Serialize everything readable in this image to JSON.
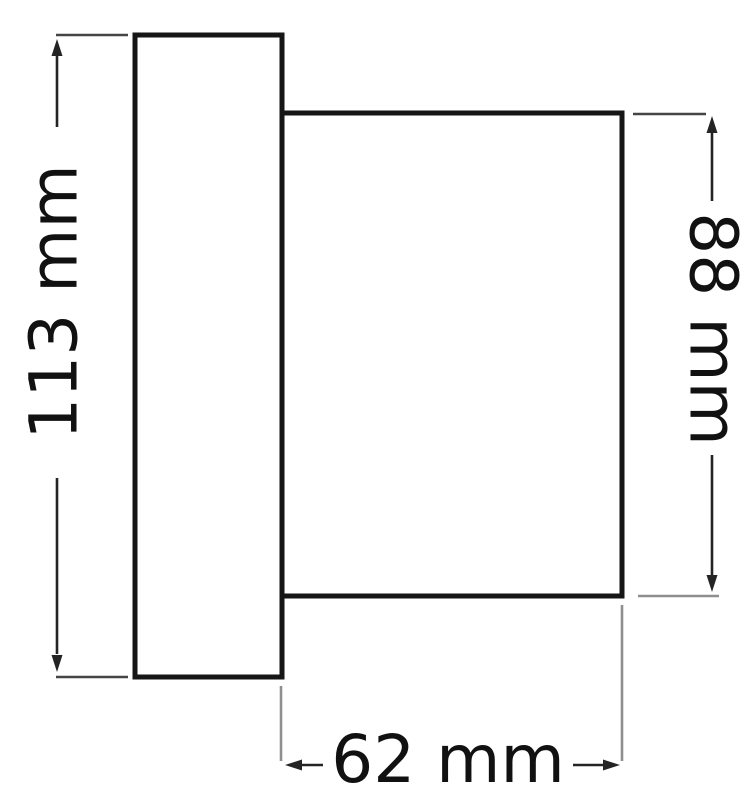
{
  "drawing": {
    "dimensions": {
      "overall_height": {
        "label": "113 mm"
      },
      "body_height": {
        "label": "88 mm"
      },
      "body_depth": {
        "label": "62 mm"
      }
    }
  },
  "colors": {
    "background": "#ffffff",
    "shape_outline": "#161616",
    "dimension_line": "#242424",
    "extension_dark": "#454545",
    "extension_gray": "#8f8f8f",
    "label_text": "#111111"
  }
}
